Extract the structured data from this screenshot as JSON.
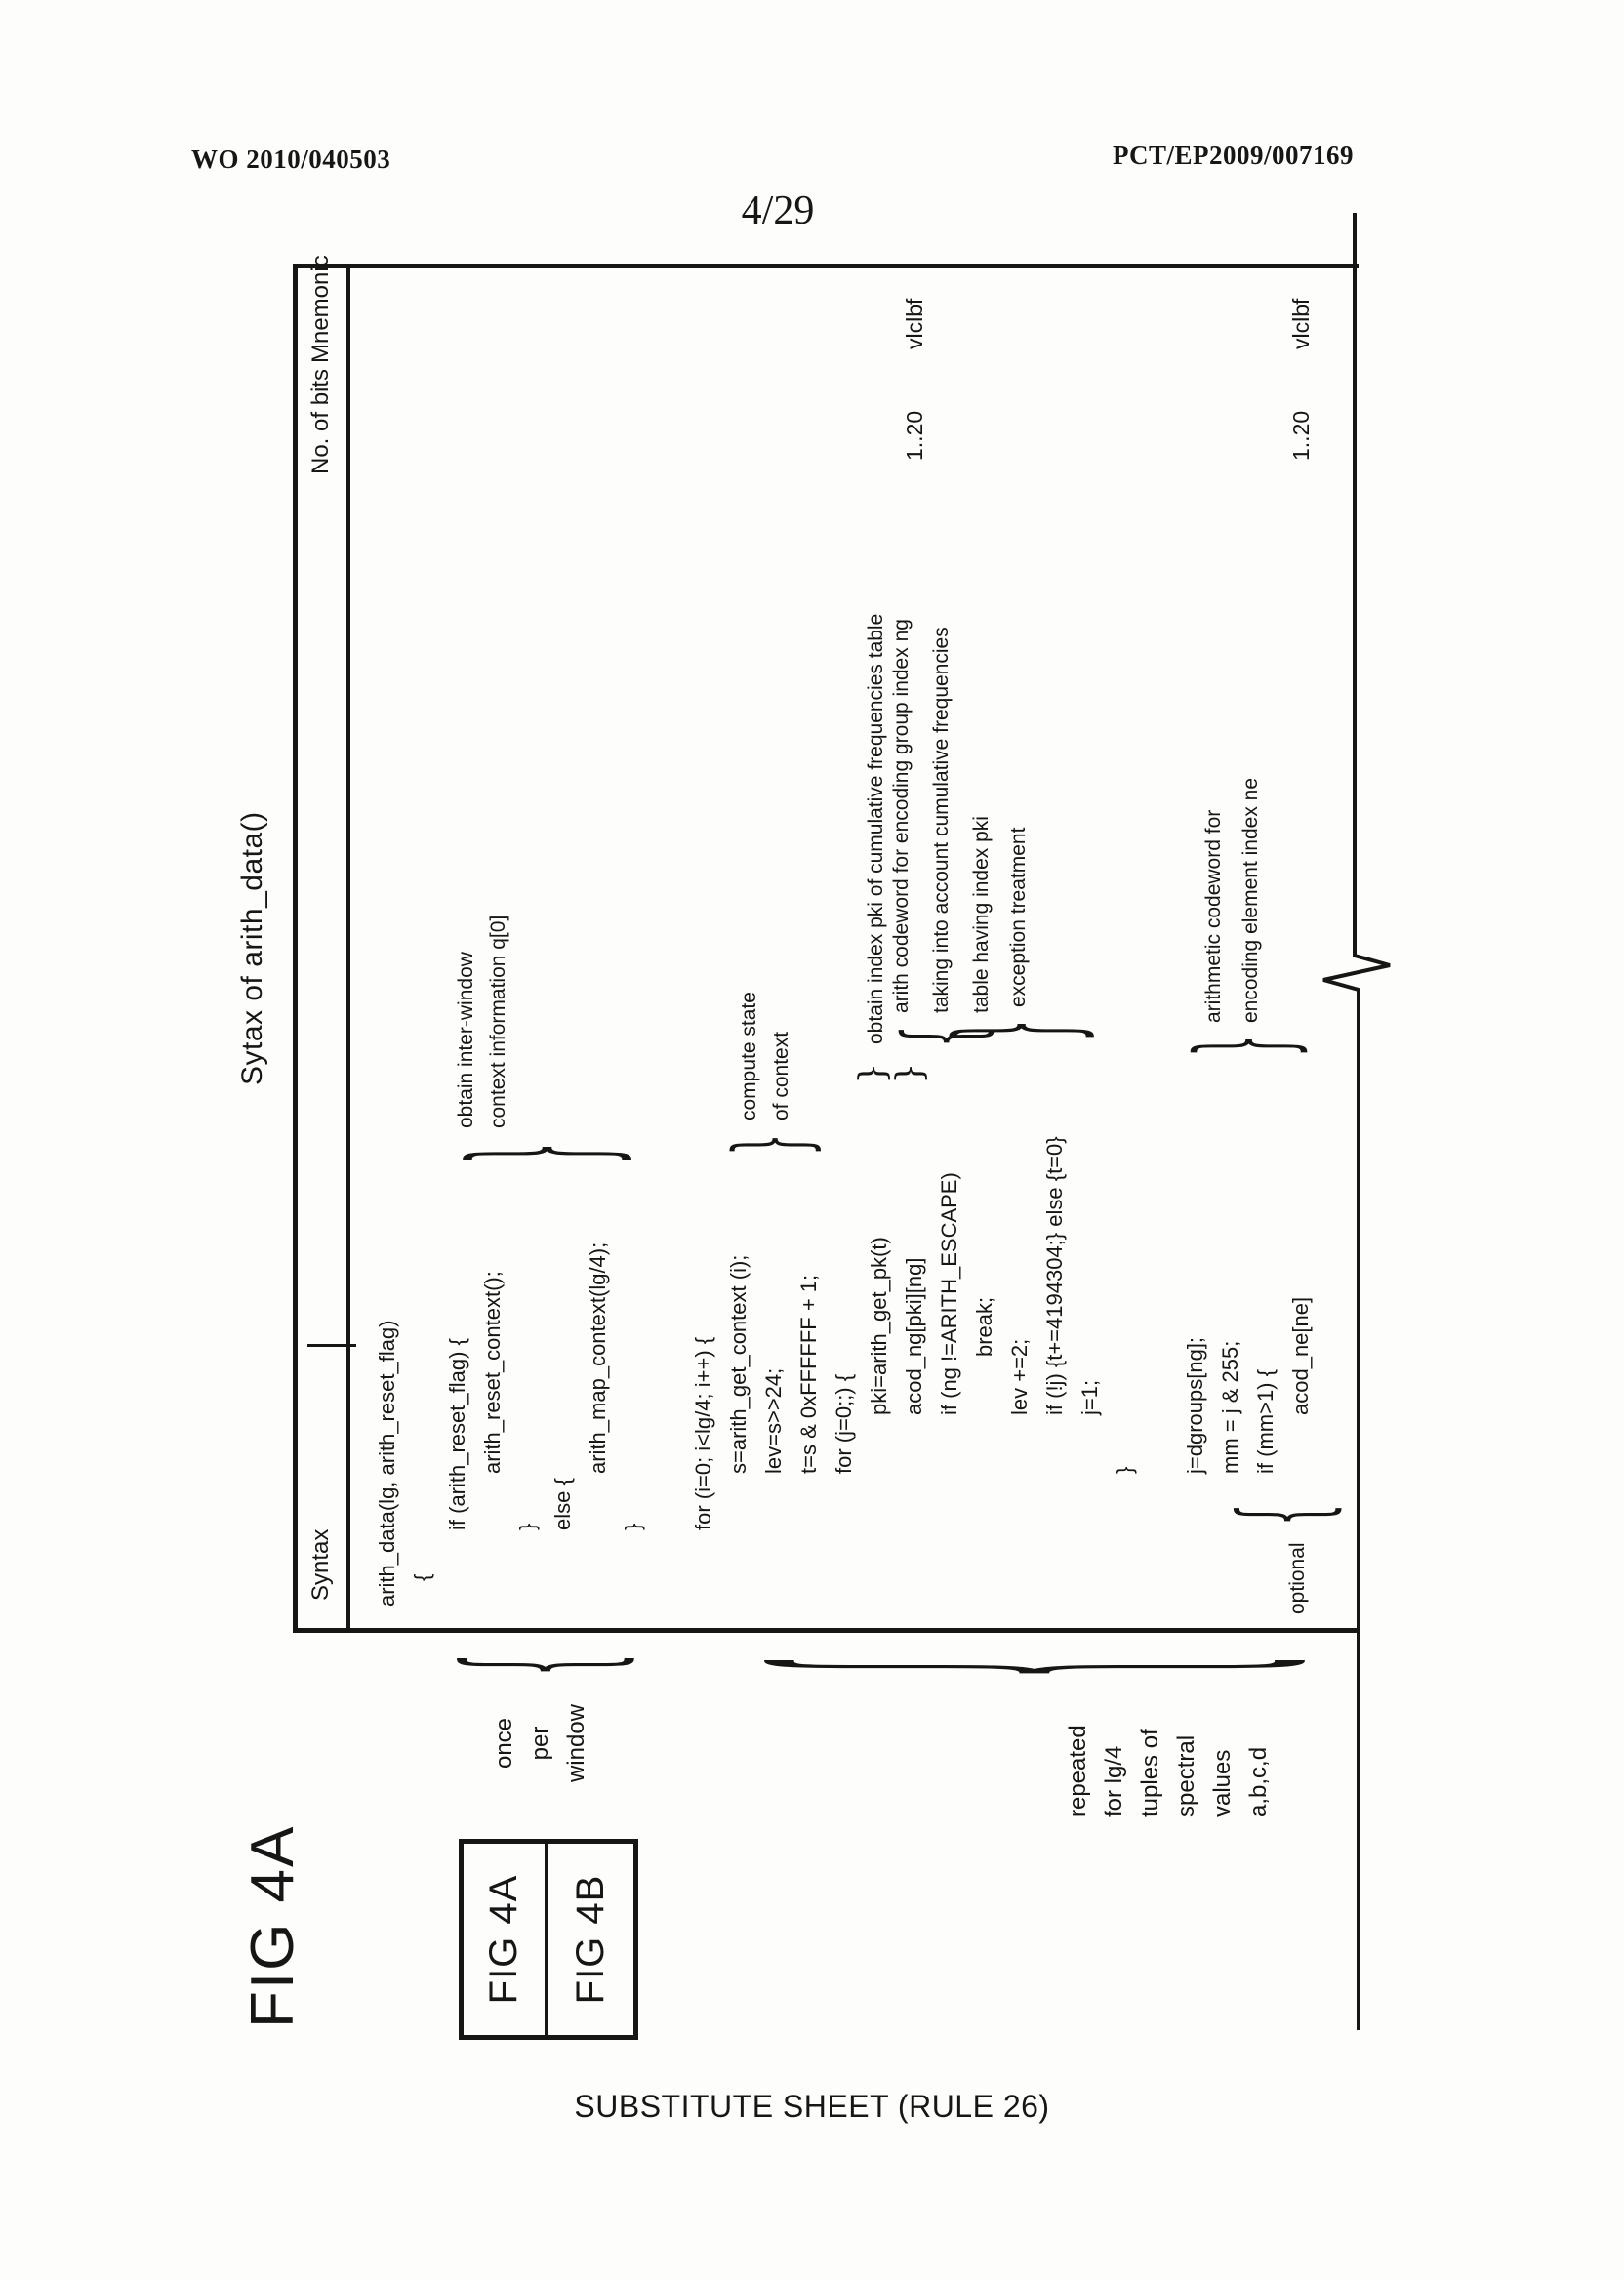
{
  "page": {
    "publication_number": "WO 2010/040503",
    "application_number": "PCT/EP2009/007169",
    "sheet_indicator": "4/29",
    "footer": "SUBSTITUTE SHEET (RULE 26)"
  },
  "figure": {
    "fig_label": "FIG 4A",
    "title": "Sytax of arith_data()",
    "key_boxes": {
      "box1": "FIG 4A",
      "box2": "FIG 4B"
    },
    "margin_notes": {
      "once_per_window": {
        "line1": "once",
        "line2": "per",
        "line3": "window"
      },
      "repeated": {
        "line1": "repeated",
        "line2": "for lg/4",
        "line3": "tuples of",
        "line4": "spectral",
        "line5": "values",
        "line6": "a,b,c,d"
      },
      "optional": "optional"
    },
    "table": {
      "headers": {
        "syntax": "Syntax",
        "bits": "No. of bits",
        "mnemonic": "Mnemonic"
      },
      "rows": [
        {
          "code": "arith_data(lg, arith_reset_flag)"
        },
        {
          "code": "{"
        },
        {
          "code": "if (arith_reset_flag) {"
        },
        {
          "code": "arith_reset_context();"
        },
        {
          "code": "}"
        },
        {
          "code": "else {"
        },
        {
          "code": "arith_map_context(lg/4);"
        },
        {
          "code": "}"
        },
        {
          "code": ""
        },
        {
          "code": "for (i=0; i<lg/4; i++) {"
        },
        {
          "code": "s=arith_get_context (i);"
        },
        {
          "code": "lev=s>>24;"
        },
        {
          "code": "t=s & 0xFFFFFF + 1;"
        },
        {
          "code": "for (j=0;;) {"
        },
        {
          "code": "pki=arith_get_pk(t)"
        },
        {
          "code": "acod_ng[pki][ng]",
          "bits": "1..20",
          "mnemonic": "vlclbf"
        },
        {
          "code": "if (ng !=ARITH_ESCAPE)"
        },
        {
          "code": "break;"
        },
        {
          "code": "lev +=2;"
        },
        {
          "code": "if (!j) {t+=4194304;} else {t=0}"
        },
        {
          "code": "j=1;"
        },
        {
          "code": "}"
        },
        {
          "code": ""
        },
        {
          "code": "j=dgroups[ng];"
        },
        {
          "code": "mm = j & 255;"
        },
        {
          "code": "if (mm>1) {"
        },
        {
          "code": "acod_ne[ne]",
          "bits": "1..20",
          "mnemonic": "vlclbf"
        }
      ]
    },
    "annotations": {
      "inter_window": {
        "line1": "obtain inter-window",
        "line2": "context information q[0]"
      },
      "compute_state": {
        "line1": "compute state",
        "line2": "of context"
      },
      "obtain_pki": "obtain index pki of cumulative frequencies table",
      "acod_ng": {
        "line1": "arith codeword for encoding group index ng",
        "line2": "taking into account cumulative frequencies",
        "line3": "table having index pki"
      },
      "exception": "exception treatment",
      "acod_ne": {
        "line1": "arithmetic codeword for",
        "line2": "encoding element index ne"
      }
    }
  }
}
